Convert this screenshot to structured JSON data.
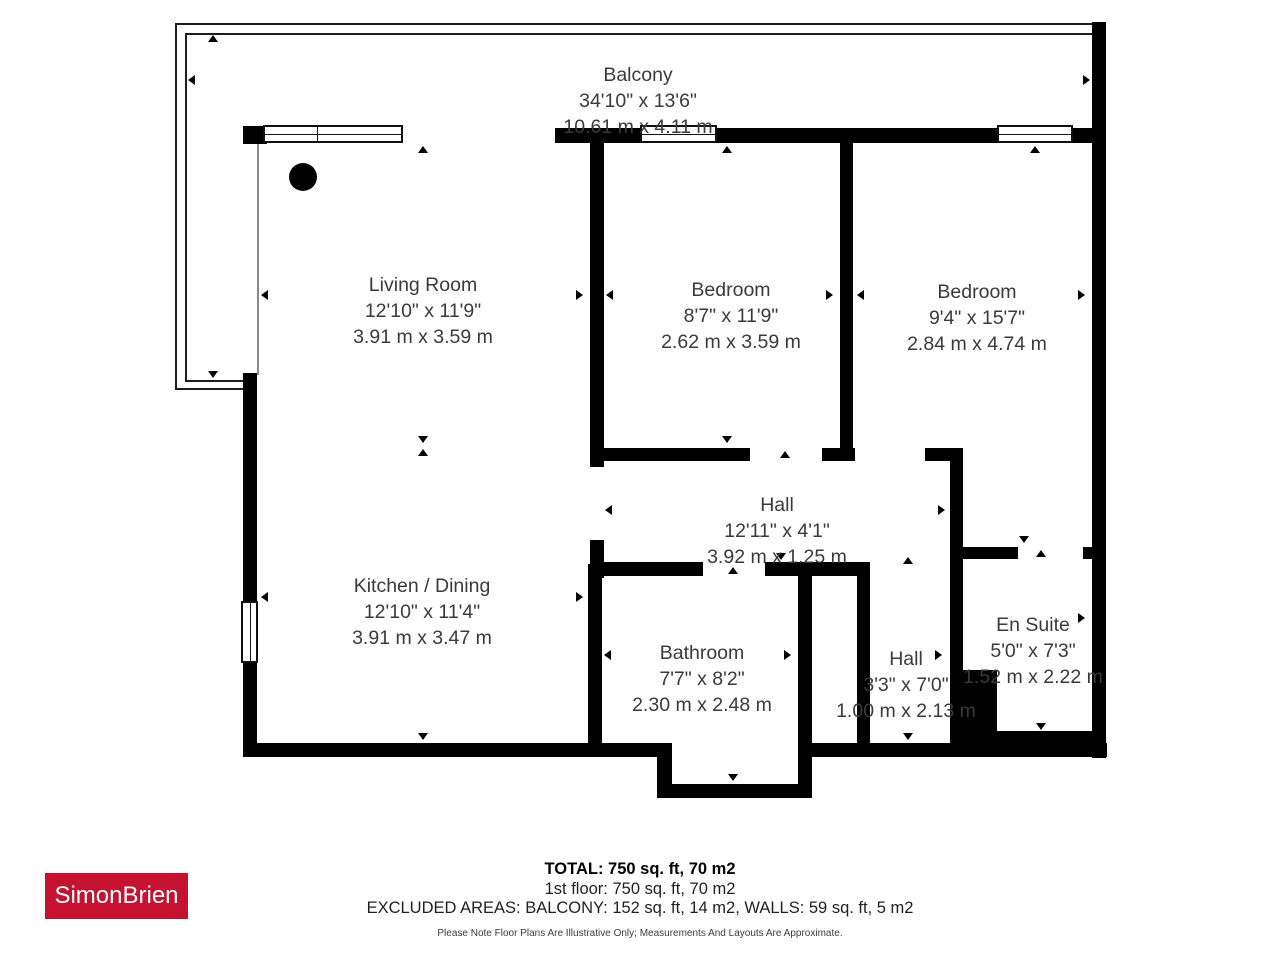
{
  "rooms": [
    {
      "name": "Balcony",
      "imperial": "34'10\" x 13'6\"",
      "metric": "10.61 m x 4.11 m"
    },
    {
      "name": "Living Room",
      "imperial": "12'10\" x 11'9\"",
      "metric": "3.91 m x 3.59 m"
    },
    {
      "name": "Bedroom",
      "imperial": "8'7\" x 11'9\"",
      "metric": "2.62 m x 3.59 m"
    },
    {
      "name": "Bedroom",
      "imperial": "9'4\" x 15'7\"",
      "metric": "2.84 m x 4.74 m"
    },
    {
      "name": "Hall",
      "imperial": "12'11\" x 4'1\"",
      "metric": "3.92 m x 1.25 m"
    },
    {
      "name": "Kitchen / Dining",
      "imperial": "12'10\" x 11'4\"",
      "metric": "3.91 m x 3.47 m"
    },
    {
      "name": "Bathroom",
      "imperial": "7'7\" x 8'2\"",
      "metric": "2.30 m x 2.48 m"
    },
    {
      "name": "Hall",
      "imperial": "3'3\" x 7'0\"",
      "metric": "1.00 m x 2.13 m"
    },
    {
      "name": "En Suite",
      "imperial": "5'0\" x 7'3\"",
      "metric": "1.52 m x 2.22 m"
    }
  ],
  "footer": {
    "total": "TOTAL: 750 sq. ft, 70 m2",
    "floor": "1st floor: 750 sq. ft, 70 m2",
    "excluded": "EXCLUDED AREAS: BALCONY: 152 sq. ft, 14 m2, WALLS: 59 sq. ft, 5 m2",
    "disclaimer": "Please Note Floor Plans Are Illustrative Only; Measurements And Layouts Are Approximate."
  },
  "logo": {
    "text": "SimonBrien",
    "background": "#c41230"
  },
  "colors": {
    "wall": "#000000",
    "label_text": "#3a3a3a",
    "logo_red": "#c41230"
  }
}
